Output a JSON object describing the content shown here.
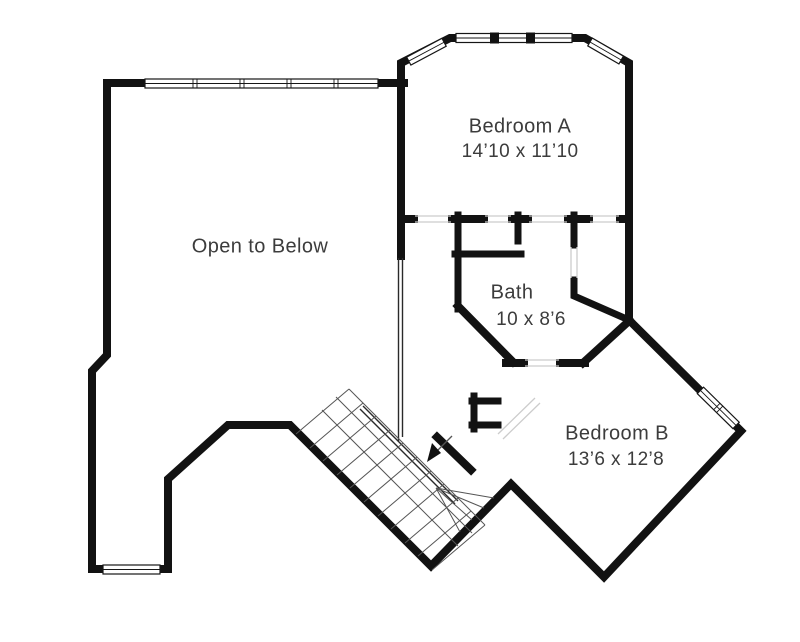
{
  "plan": {
    "type": "second-floor-plan",
    "rooms": {
      "open_to_below": {
        "label": "Open to Below"
      },
      "bedroom_a": {
        "label": "Bedroom A",
        "dimensions": "14’10 x 11’10"
      },
      "bath": {
        "label": "Bath",
        "dimensions": "10 x 8’6"
      },
      "bedroom_b": {
        "label": "Bedroom B",
        "dimensions": "13’6 x 12’8"
      }
    },
    "features": [
      "staircase",
      "stairs-direction-arrow",
      "windows",
      "closets"
    ]
  },
  "colors": {
    "wall": "#121212",
    "label_text": "#3c3c3c",
    "background": "#ffffff"
  }
}
